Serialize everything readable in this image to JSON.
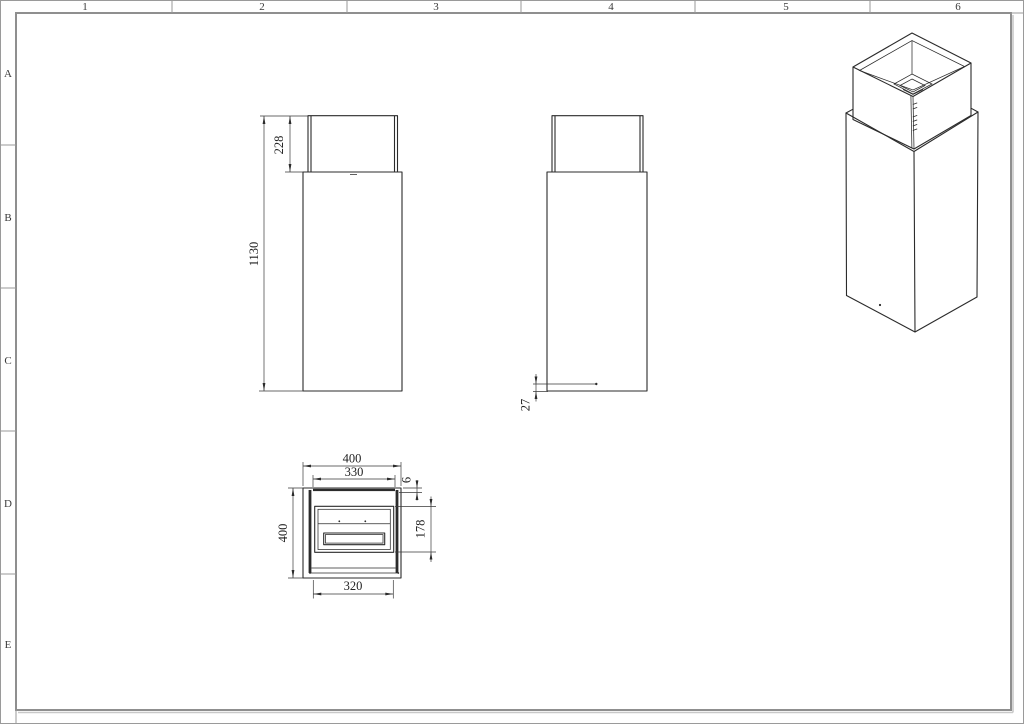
{
  "sheet": {
    "column_labels": [
      "1",
      "2",
      "3",
      "4",
      "5",
      "6"
    ],
    "row_labels": [
      "A",
      "B",
      "C",
      "D",
      "E"
    ]
  },
  "dimensions": {
    "front": {
      "glass_height": "228",
      "total_height": "1130"
    },
    "side": {
      "base_plate_offset": "27"
    },
    "plan": {
      "outer_width": "400",
      "glass_width": "330",
      "glass_offset": "6",
      "outer_depth": "400",
      "burner_depth": "178",
      "opening_width": "320"
    }
  },
  "colors": {
    "line": "#2b2b2b",
    "frame": "#8f8f8f",
    "dim_text": "#222222",
    "background": "#ffffff"
  }
}
